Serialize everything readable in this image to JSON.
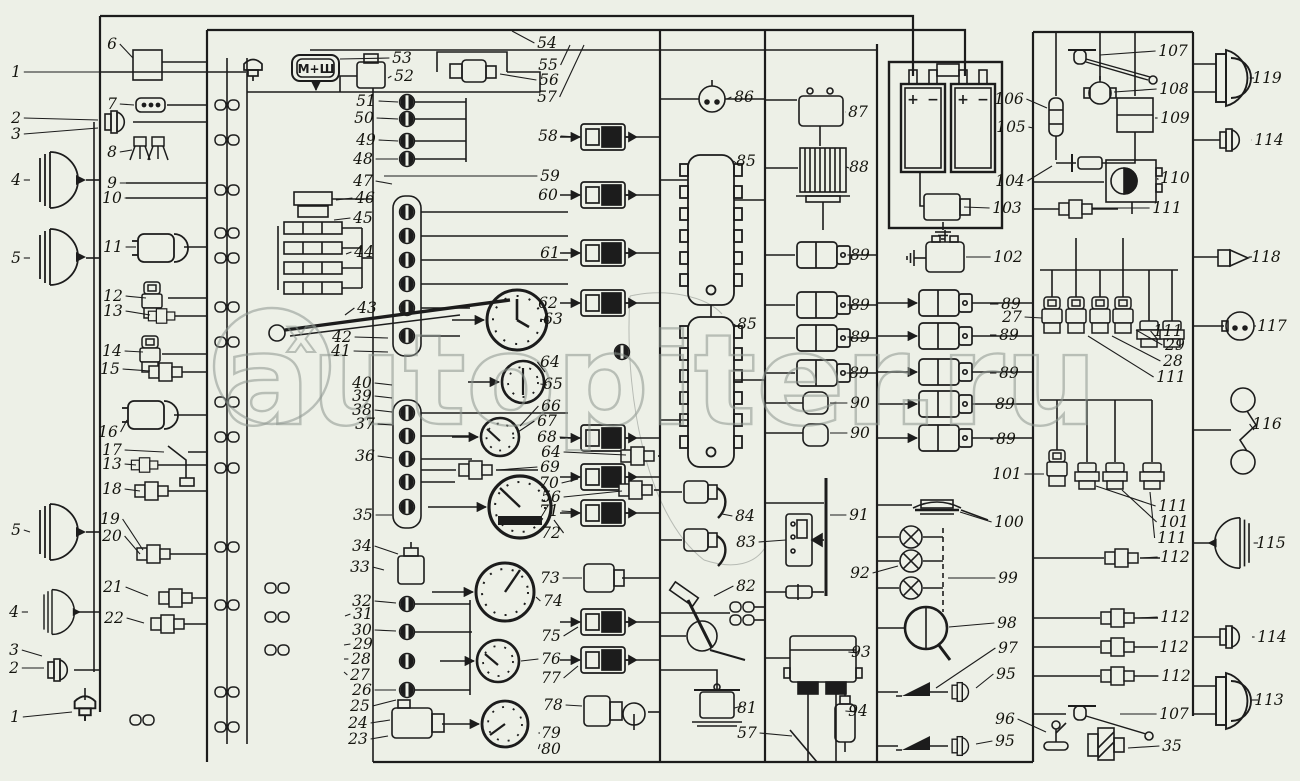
{
  "page": {
    "background": "#edf0e7",
    "ink": "#1c1c1c",
    "watermark_color": "#8d968f"
  },
  "watermark": {
    "text": "autopiter.ru",
    "logo_x": "x"
  },
  "labels": {
    "control_box": "М+Ш"
  },
  "battery": {
    "plus": "+",
    "minus": "−"
  },
  "callouts": [
    {
      "n": "1",
      "x": 16,
      "y": 72,
      "lx": 240,
      "ly": 72
    },
    {
      "n": "6",
      "x": 112,
      "y": 44,
      "lx": 133,
      "ly": 58
    },
    {
      "n": "2",
      "x": 16,
      "y": 118,
      "lx": 98,
      "ly": 120
    },
    {
      "n": "3",
      "x": 16,
      "y": 134,
      "lx": 98,
      "ly": 128
    },
    {
      "n": "7",
      "x": 112,
      "y": 104,
      "lx": 134,
      "ly": 105
    },
    {
      "n": "8",
      "x": 112,
      "y": 152,
      "lx": 132,
      "ly": 150
    },
    {
      "n": "4",
      "x": 16,
      "y": 180,
      "lx": 30,
      "ly": 180
    },
    {
      "n": "9",
      "x": 112,
      "y": 183,
      "lx": 205,
      "ly": 183
    },
    {
      "n": "10",
      "x": 112,
      "y": 198,
      "lx": 205,
      "ly": 198
    },
    {
      "n": "5",
      "x": 16,
      "y": 258,
      "lx": 30,
      "ly": 258
    },
    {
      "n": "11",
      "x": 113,
      "y": 247,
      "lx": 136,
      "ly": 247
    },
    {
      "n": "12",
      "x": 113,
      "y": 296,
      "lx": 146,
      "ly": 298
    },
    {
      "n": "13",
      "x": 113,
      "y": 311,
      "lx": 150,
      "ly": 315
    },
    {
      "n": "14",
      "x": 112,
      "y": 351,
      "lx": 143,
      "ly": 352
    },
    {
      "n": "15",
      "x": 110,
      "y": 369,
      "lx": 150,
      "ly": 371
    },
    {
      "n": "16",
      "x": 108,
      "y": 432,
      "lx": 127,
      "ly": 420
    },
    {
      "n": "17",
      "x": 112,
      "y": 450,
      "lx": 164,
      "ly": 452
    },
    {
      "n": "13",
      "x": 112,
      "y": 464,
      "lx": 136,
      "ly": 465
    },
    {
      "n": "18",
      "x": 112,
      "y": 489,
      "lx": 140,
      "ly": 491
    },
    {
      "n": "19",
      "x": 110,
      "y": 519,
      "lx": 143,
      "ly": 550
    },
    {
      "n": "20",
      "x": 112,
      "y": 536,
      "lx": 140,
      "ly": 554
    },
    {
      "n": "5",
      "x": 16,
      "y": 530,
      "lx": 30,
      "ly": 532
    },
    {
      "n": "21",
      "x": 113,
      "y": 587,
      "lx": 148,
      "ly": 596
    },
    {
      "n": "22",
      "x": 114,
      "y": 618,
      "lx": 144,
      "ly": 623
    },
    {
      "n": "4",
      "x": 14,
      "y": 612,
      "lx": 28,
      "ly": 612
    },
    {
      "n": "3",
      "x": 14,
      "y": 650,
      "lx": 42,
      "ly": 656
    },
    {
      "n": "2",
      "x": 14,
      "y": 668,
      "lx": 44,
      "ly": 668
    },
    {
      "n": "1",
      "x": 15,
      "y": 717,
      "lx": 72,
      "ly": 712
    },
    {
      "n": "53",
      "x": 402,
      "y": 58,
      "lx": 340,
      "ly": 59
    },
    {
      "n": "52",
      "x": 404,
      "y": 76,
      "lx": 388,
      "ly": 78
    },
    {
      "n": "51",
      "x": 366,
      "y": 101,
      "lx": 398,
      "ly": 102
    },
    {
      "n": "50",
      "x": 364,
      "y": 118,
      "lx": 398,
      "ly": 119
    },
    {
      "n": "49",
      "x": 366,
      "y": 140,
      "lx": 398,
      "ly": 141
    },
    {
      "n": "48",
      "x": 363,
      "y": 159,
      "lx": 398,
      "ly": 159
    },
    {
      "n": "47",
      "x": 363,
      "y": 181,
      "lx": 392,
      "ly": 184
    },
    {
      "n": "46",
      "x": 365,
      "y": 198,
      "lx": 336,
      "ly": 200
    },
    {
      "n": "45",
      "x": 363,
      "y": 218,
      "lx": 334,
      "ly": 220
    },
    {
      "n": "44",
      "x": 364,
      "y": 252,
      "lx": 346,
      "ly": 254
    },
    {
      "n": "43",
      "x": 367,
      "y": 308,
      "lx": 345,
      "ly": 315
    },
    {
      "n": "42",
      "x": 342,
      "y": 337,
      "lx": 388,
      "ly": 338
    },
    {
      "n": "41",
      "x": 341,
      "y": 351,
      "lx": 388,
      "ly": 352
    },
    {
      "n": "40",
      "x": 362,
      "y": 383,
      "lx": 392,
      "ly": 385
    },
    {
      "n": "39",
      "x": 362,
      "y": 396,
      "lx": 392,
      "ly": 398
    },
    {
      "n": "38",
      "x": 362,
      "y": 410,
      "lx": 392,
      "ly": 412
    },
    {
      "n": "37",
      "x": 365,
      "y": 424,
      "lx": 392,
      "ly": 425
    },
    {
      "n": "36",
      "x": 365,
      "y": 456,
      "lx": 392,
      "ly": 458
    },
    {
      "n": "35",
      "x": 363,
      "y": 515,
      "lx": 392,
      "ly": 515
    },
    {
      "n": "34",
      "x": 362,
      "y": 546,
      "lx": 398,
      "ly": 554
    },
    {
      "n": "33",
      "x": 360,
      "y": 567,
      "lx": 384,
      "ly": 570
    },
    {
      "n": "32",
      "x": 362,
      "y": 601,
      "lx": 396,
      "ly": 603
    },
    {
      "n": "31",
      "x": 363,
      "y": 614,
      "lx": 345,
      "ly": 616
    },
    {
      "n": "30",
      "x": 362,
      "y": 630,
      "lx": 396,
      "ly": 631
    },
    {
      "n": "29",
      "x": 363,
      "y": 644,
      "lx": 344,
      "ly": 645
    },
    {
      "n": "28",
      "x": 361,
      "y": 659,
      "lx": 344,
      "ly": 659
    },
    {
      "n": "27",
      "x": 360,
      "y": 675,
      "lx": 344,
      "ly": 672
    },
    {
      "n": "26",
      "x": 362,
      "y": 690,
      "lx": 396,
      "ly": 690
    },
    {
      "n": "25",
      "x": 360,
      "y": 706,
      "lx": 396,
      "ly": 700
    },
    {
      "n": "24",
      "x": 358,
      "y": 723,
      "lx": 390,
      "ly": 720
    },
    {
      "n": "23",
      "x": 358,
      "y": 739,
      "lx": 388,
      "ly": 736
    },
    {
      "n": "54",
      "x": 547,
      "y": 43,
      "lx": 512,
      "ly": 31
    },
    {
      "n": "55",
      "x": 548,
      "y": 65,
      "lx": 570,
      "ly": 45
    },
    {
      "n": "56",
      "x": 549,
      "y": 80,
      "lx": 500,
      "ly": 74
    },
    {
      "n": "57",
      "x": 547,
      "y": 97,
      "lx": 584,
      "ly": 45
    },
    {
      "n": "58",
      "x": 548,
      "y": 136,
      "lx": 578,
      "ly": 137
    },
    {
      "n": "59",
      "x": 550,
      "y": 176,
      "lx": 384,
      "ly": 176
    },
    {
      "n": "60",
      "x": 548,
      "y": 195,
      "lx": 578,
      "ly": 195
    },
    {
      "n": "61",
      "x": 550,
      "y": 253,
      "lx": 578,
      "ly": 253
    },
    {
      "n": "62",
      "x": 548,
      "y": 303,
      "lx": 578,
      "ly": 303
    },
    {
      "n": "63",
      "x": 553,
      "y": 319,
      "lx": 549,
      "ly": 321
    },
    {
      "n": "64",
      "x": 550,
      "y": 362,
      "lx": 545,
      "ly": 372
    },
    {
      "n": "65",
      "x": 553,
      "y": 384,
      "lx": 547,
      "ly": 385
    },
    {
      "n": "66",
      "x": 551,
      "y": 406,
      "lx": 520,
      "ly": 426
    },
    {
      "n": "67",
      "x": 547,
      "y": 421,
      "lx": 518,
      "ly": 432
    },
    {
      "n": "68",
      "x": 547,
      "y": 437,
      "lx": 578,
      "ly": 438
    },
    {
      "n": "64",
      "x": 551,
      "y": 452,
      "lx": 626,
      "ly": 455
    },
    {
      "n": "69",
      "x": 550,
      "y": 467,
      "lx": 498,
      "ly": 470
    },
    {
      "n": "70",
      "x": 549,
      "y": 483,
      "lx": 578,
      "ly": 479
    },
    {
      "n": "56",
      "x": 551,
      "y": 497,
      "lx": 622,
      "ly": 491
    },
    {
      "n": "71",
      "x": 549,
      "y": 511,
      "lx": 578,
      "ly": 512
    },
    {
      "n": "72",
      "x": 551,
      "y": 533,
      "lx": 554,
      "ly": 520
    },
    {
      "n": "73",
      "x": 550,
      "y": 578,
      "lx": 582,
      "ly": 578
    },
    {
      "n": "74",
      "x": 553,
      "y": 601,
      "lx": 536,
      "ly": 597
    },
    {
      "n": "75",
      "x": 551,
      "y": 636,
      "lx": 578,
      "ly": 627
    },
    {
      "n": "76",
      "x": 551,
      "y": 659,
      "lx": 521,
      "ly": 661
    },
    {
      "n": "77",
      "x": 551,
      "y": 678,
      "lx": 578,
      "ly": 666
    },
    {
      "n": "78",
      "x": 553,
      "y": 705,
      "lx": 582,
      "ly": 706
    },
    {
      "n": "79",
      "x": 551,
      "y": 733,
      "lx": 540,
      "ly": 733
    },
    {
      "n": "80",
      "x": 551,
      "y": 749,
      "lx": 540,
      "ly": 744
    },
    {
      "n": "86",
      "x": 744,
      "y": 97,
      "lx": 727,
      "ly": 99
    },
    {
      "n": "85",
      "x": 746,
      "y": 161,
      "lx": 736,
      "ly": 163
    },
    {
      "n": "85",
      "x": 747,
      "y": 324,
      "lx": 736,
      "ly": 327
    },
    {
      "n": "84",
      "x": 745,
      "y": 516,
      "lx": 722,
      "ly": 514
    },
    {
      "n": "83",
      "x": 746,
      "y": 542,
      "lx": 786,
      "ly": 540
    },
    {
      "n": "82",
      "x": 746,
      "y": 586,
      "lx": 714,
      "ly": 596
    },
    {
      "n": "81",
      "x": 747,
      "y": 708,
      "lx": 742,
      "ly": 706
    },
    {
      "n": "57",
      "x": 747,
      "y": 733,
      "lx": 792,
      "ly": 736
    },
    {
      "n": "87",
      "x": 858,
      "y": 112,
      "lx": 845,
      "ly": 112
    },
    {
      "n": "88",
      "x": 859,
      "y": 167,
      "lx": 849,
      "ly": 168
    },
    {
      "n": "89",
      "x": 860,
      "y": 255,
      "lx": 852,
      "ly": 255
    },
    {
      "n": "89",
      "x": 860,
      "y": 305,
      "lx": 852,
      "ly": 305
    },
    {
      "n": "89",
      "x": 860,
      "y": 337,
      "lx": 852,
      "ly": 337
    },
    {
      "n": "89",
      "x": 859,
      "y": 373,
      "lx": 852,
      "ly": 373
    },
    {
      "n": "90",
      "x": 860,
      "y": 403,
      "lx": 830,
      "ly": 403
    },
    {
      "n": "90",
      "x": 860,
      "y": 433,
      "lx": 830,
      "ly": 433
    },
    {
      "n": "91",
      "x": 859,
      "y": 515,
      "lx": 830,
      "ly": 515
    },
    {
      "n": "92",
      "x": 860,
      "y": 573,
      "lx": 898,
      "ly": 566
    },
    {
      "n": "93",
      "x": 861,
      "y": 652,
      "lx": 858,
      "ly": 653
    },
    {
      "n": "94",
      "x": 858,
      "y": 711,
      "lx": 856,
      "ly": 712
    },
    {
      "n": "106",
      "x": 1009,
      "y": 99,
      "lx": 1047,
      "ly": 108
    },
    {
      "n": "105",
      "x": 1011,
      "y": 127,
      "lx": 1033,
      "ly": 128
    },
    {
      "n": "104",
      "x": 1010,
      "y": 181,
      "lx": 1052,
      "ly": 166
    },
    {
      "n": "103",
      "x": 1007,
      "y": 208,
      "lx": 964,
      "ly": 207
    },
    {
      "n": "102",
      "x": 1008,
      "y": 257,
      "lx": 966,
      "ly": 257
    },
    {
      "n": "89",
      "x": 1011,
      "y": 304,
      "lx": 990,
      "ly": 304
    },
    {
      "n": "27",
      "x": 1012,
      "y": 317,
      "lx": 1042,
      "ly": 318
    },
    {
      "n": "89",
      "x": 1009,
      "y": 335,
      "lx": 990,
      "ly": 335
    },
    {
      "n": "89",
      "x": 1009,
      "y": 373,
      "lx": 990,
      "ly": 373
    },
    {
      "n": "89",
      "x": 1005,
      "y": 404,
      "lx": 990,
      "ly": 404
    },
    {
      "n": "89",
      "x": 1006,
      "y": 439,
      "lx": 990,
      "ly": 439
    },
    {
      "n": "101",
      "x": 1007,
      "y": 474,
      "lx": 1044,
      "ly": 474
    },
    {
      "n": "100",
      "x": 1009,
      "y": 522,
      "lx": 960,
      "ly": 512
    },
    {
      "n": "99",
      "x": 1008,
      "y": 578,
      "lx": 948,
      "ly": 578
    },
    {
      "n": "98",
      "x": 1007,
      "y": 623,
      "lx": 949,
      "ly": 627
    },
    {
      "n": "97",
      "x": 1008,
      "y": 648,
      "lx": 936,
      "ly": 688
    },
    {
      "n": "95",
      "x": 1006,
      "y": 674,
      "lx": 976,
      "ly": 688
    },
    {
      "n": "96",
      "x": 1005,
      "y": 719,
      "lx": 1046,
      "ly": 732
    },
    {
      "n": "95",
      "x": 1005,
      "y": 741,
      "lx": 976,
      "ly": 744
    },
    {
      "n": "107",
      "x": 1173,
      "y": 51,
      "lx": 1100,
      "ly": 55
    },
    {
      "n": "108",
      "x": 1174,
      "y": 89,
      "lx": 1114,
      "ly": 92
    },
    {
      "n": "109",
      "x": 1175,
      "y": 118,
      "lx": 1155,
      "ly": 118
    },
    {
      "n": "110",
      "x": 1175,
      "y": 178,
      "lx": 1158,
      "ly": 180
    },
    {
      "n": "111",
      "x": 1167,
      "y": 208,
      "lx": 1092,
      "ly": 208
    },
    {
      "n": "111",
      "x": 1168,
      "y": 331,
      "lx": 1158,
      "ly": 340
    },
    {
      "n": "29",
      "x": 1175,
      "y": 345,
      "lx": 1136,
      "ly": 330
    },
    {
      "n": "28",
      "x": 1173,
      "y": 361,
      "lx": 1112,
      "ly": 336
    },
    {
      "n": "111",
      "x": 1171,
      "y": 377,
      "lx": 1088,
      "ly": 336
    },
    {
      "n": "111",
      "x": 1173,
      "y": 506,
      "lx": 1096,
      "ly": 486
    },
    {
      "n": "101",
      "x": 1174,
      "y": 522,
      "lx": 1122,
      "ly": 490
    },
    {
      "n": "111",
      "x": 1172,
      "y": 538,
      "lx": 1150,
      "ly": 492
    },
    {
      "n": "112",
      "x": 1175,
      "y": 557,
      "lx": 1142,
      "ly": 558
    },
    {
      "n": "112",
      "x": 1175,
      "y": 617,
      "lx": 1138,
      "ly": 618
    },
    {
      "n": "112",
      "x": 1174,
      "y": 647,
      "lx": 1136,
      "ly": 647
    },
    {
      "n": "112",
      "x": 1176,
      "y": 676,
      "lx": 1136,
      "ly": 676
    },
    {
      "n": "107",
      "x": 1174,
      "y": 714,
      "lx": 1120,
      "ly": 714
    },
    {
      "n": "35",
      "x": 1172,
      "y": 746,
      "lx": 1128,
      "ly": 748
    },
    {
      "n": "119",
      "x": 1267,
      "y": 78,
      "lx": 1254,
      "ly": 78
    },
    {
      "n": "114",
      "x": 1269,
      "y": 140,
      "lx": 1252,
      "ly": 140
    },
    {
      "n": "118",
      "x": 1266,
      "y": 257,
      "lx": 1252,
      "ly": 257
    },
    {
      "n": "117",
      "x": 1272,
      "y": 326,
      "lx": 1256,
      "ly": 326
    },
    {
      "n": "116",
      "x": 1267,
      "y": 424,
      "lx": 1254,
      "ly": 430
    },
    {
      "n": "115",
      "x": 1271,
      "y": 543,
      "lx": 1258,
      "ly": 543
    },
    {
      "n": "114",
      "x": 1272,
      "y": 637,
      "lx": 1252,
      "ly": 637
    },
    {
      "n": "113",
      "x": 1269,
      "y": 700,
      "lx": 1258,
      "ly": 700
    }
  ]
}
